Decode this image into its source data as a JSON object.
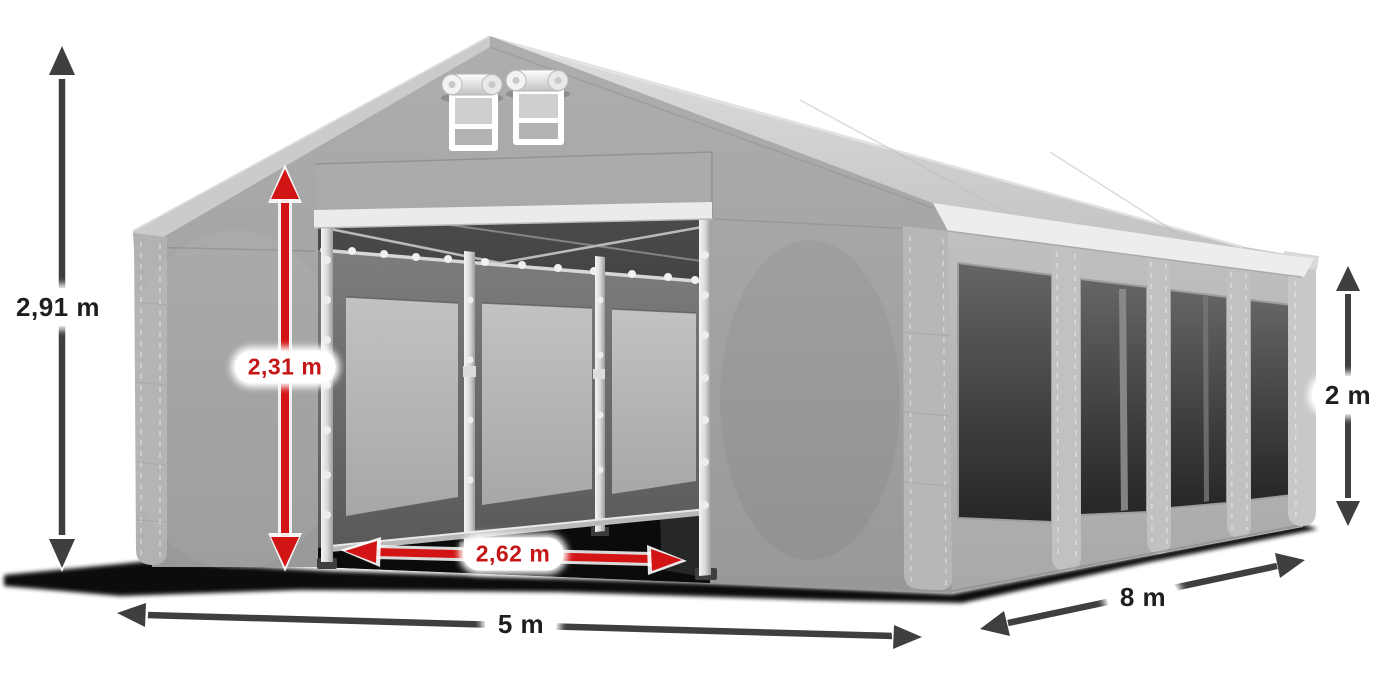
{
  "scene": {
    "description": "Dimensioned product illustration of a grey 5 x 8 m storage tent with open entrance",
    "background_color": "#ffffff"
  },
  "tent": {
    "colors": {
      "roof": "#d0d0d0",
      "gable_and_front_wall": "#a6a6a6",
      "side_wall": "#b3b3b3",
      "window_mesh": "#3e3e3e",
      "frame_poles": "#e8e8e8",
      "vent_frame": "#ffffff"
    },
    "features": [
      "gable-vent-left",
      "gable-vent-right",
      "open-entrance",
      "interior-frame",
      "four-side-windows"
    ]
  },
  "dimensions": {
    "arrow_dark_color": "#3f3f3f",
    "arrow_red_color": "#d31414",
    "label_background": "#ffffff",
    "total_height": {
      "label": "2,91 m",
      "style": "dark",
      "orientation": "vertical"
    },
    "entrance_height": {
      "label": "2,31 m",
      "style": "red",
      "orientation": "vertical"
    },
    "entrance_width": {
      "label": "2,62 m",
      "style": "red",
      "orientation": "horizontal"
    },
    "front_width": {
      "label": "5 m",
      "style": "dark",
      "orientation": "horizontal"
    },
    "side_length": {
      "label": "8 m",
      "style": "dark",
      "orientation": "diagonal"
    },
    "side_wall_height": {
      "label": "2 m",
      "style": "dark",
      "orientation": "vertical"
    }
  }
}
